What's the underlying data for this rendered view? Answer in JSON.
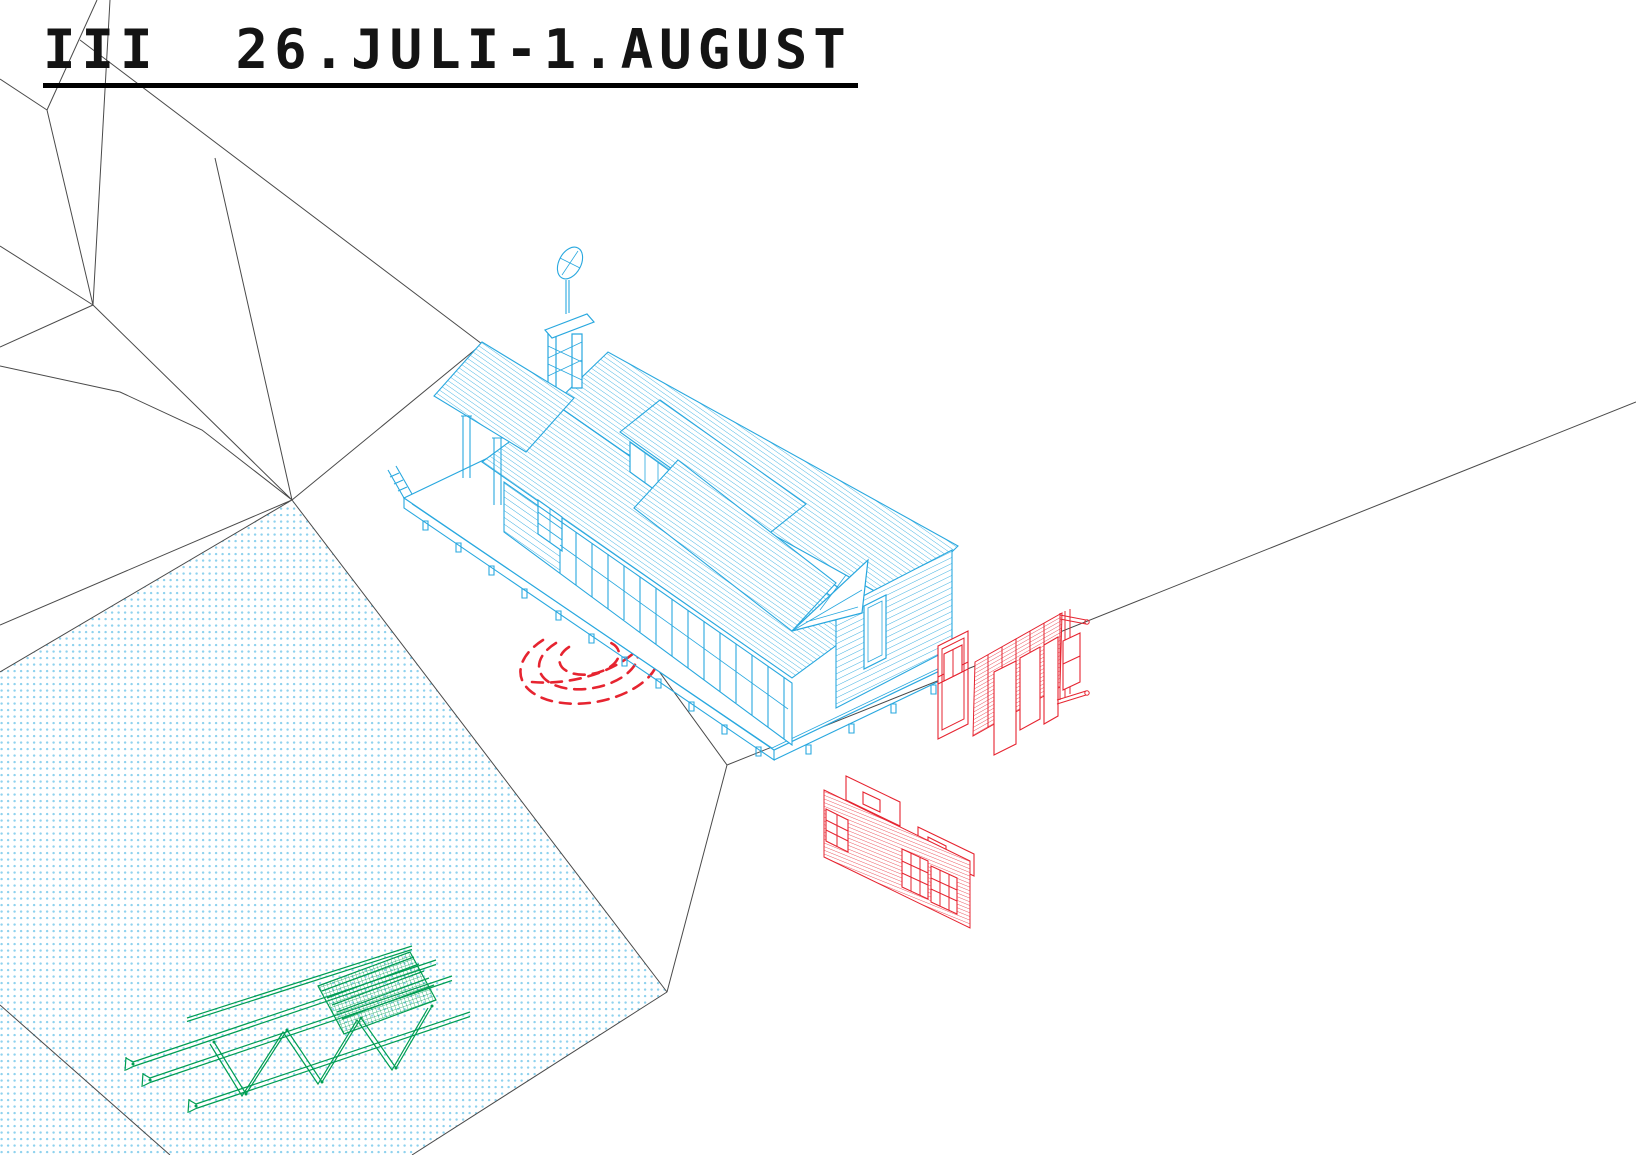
{
  "title": {
    "text": "III  26.JULI-1.AUGUST"
  },
  "colors": {
    "building_cyan": "#29a8df",
    "panel_red": "#e62430",
    "truss_green": "#009e53",
    "terrain_line": "#4a4a4a",
    "water_dots": "#8fd2ee",
    "title_text": "#141414",
    "underline": "#000000"
  }
}
